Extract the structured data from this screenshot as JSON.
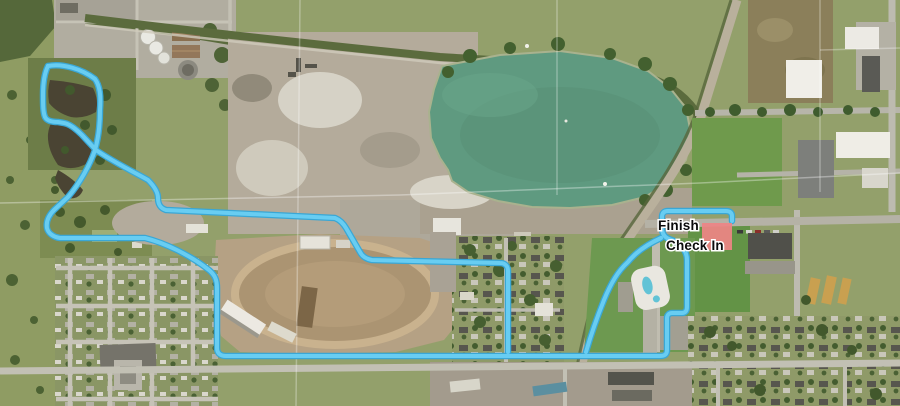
{
  "map": {
    "labels": {
      "finish": "Finish",
      "check_in": "Check In"
    },
    "colors": {
      "route": "#68cdf2",
      "route_outline": "#3aa7d5",
      "check_in_area": "#ee8486",
      "lake": "#5f9a80",
      "pond": "#4a4433"
    }
  }
}
